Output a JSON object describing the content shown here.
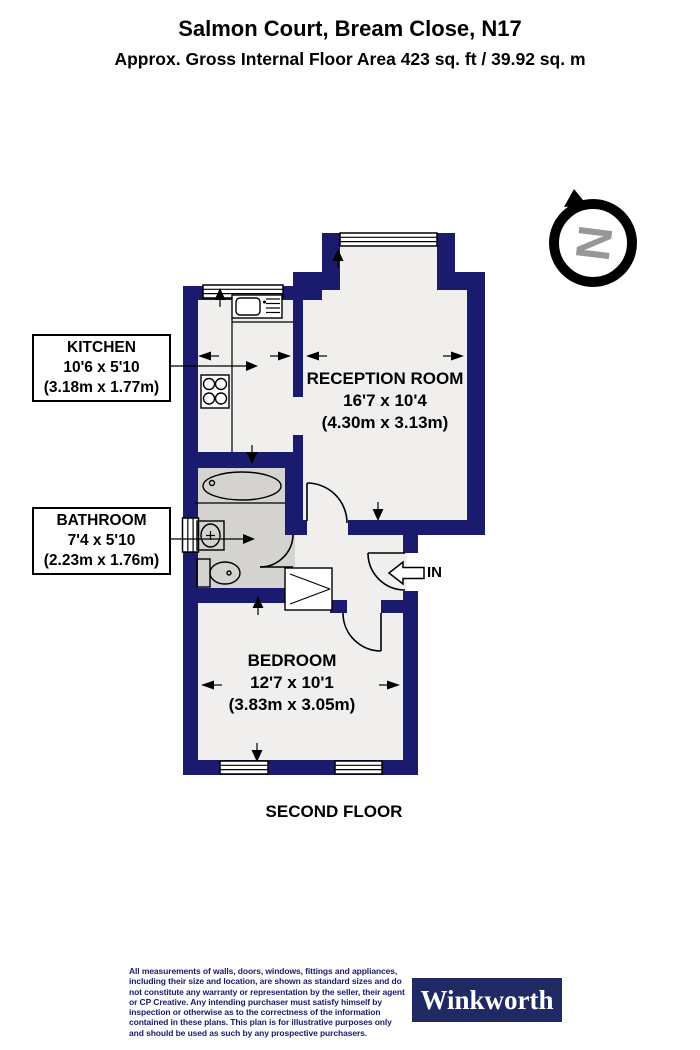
{
  "header": {
    "title": "Salmon Court, Bream Close, N17",
    "subtitle": "Approx. Gross Internal Floor Area 423 sq. ft / 39.92 sq. m"
  },
  "compass": {
    "north_letter": "N"
  },
  "rooms": {
    "kitchen": {
      "name": "KITCHEN",
      "size_imperial": "10'6 x 5'10",
      "size_metric": "(3.18m x 1.77m)"
    },
    "reception": {
      "name": "RECEPTION ROOM",
      "size_imperial": "16'7 x 10'4",
      "size_metric": "(4.30m x 3.13m)"
    },
    "bathroom": {
      "name": "BATHROOM",
      "size_imperial": "7'4 x 5'10",
      "size_metric": "(2.23m x 1.76m)"
    },
    "bedroom": {
      "name": "BEDROOM",
      "size_imperial": "12'7 x 10'1",
      "size_metric": "(3.83m x 3.05m)"
    }
  },
  "entrance": {
    "label": "IN"
  },
  "floor_label": "SECOND FLOOR",
  "footer": {
    "disclaimer": "All measurements of walls, doors, windows, fittings and appliances, including their size and location, are shown as standard sizes and do not constitute any warranty or representation by the seller, their agent or CP Creative. Any intending purchaser must satisfy himself by inspection or otherwise as to the correctness of the information contained in these plans. This plan is for illustrative purposes only and should be used as such by any prospective purchasers.",
    "brand": "Winkworth"
  },
  "colors": {
    "wall": "#1a1a6e",
    "floor": "#f0efed",
    "bathroom_floor": "#d4d3cf",
    "brand_navy": "#1f2963",
    "compass_gray": "#979797",
    "disclaimer_text": "#1a1a6e"
  }
}
